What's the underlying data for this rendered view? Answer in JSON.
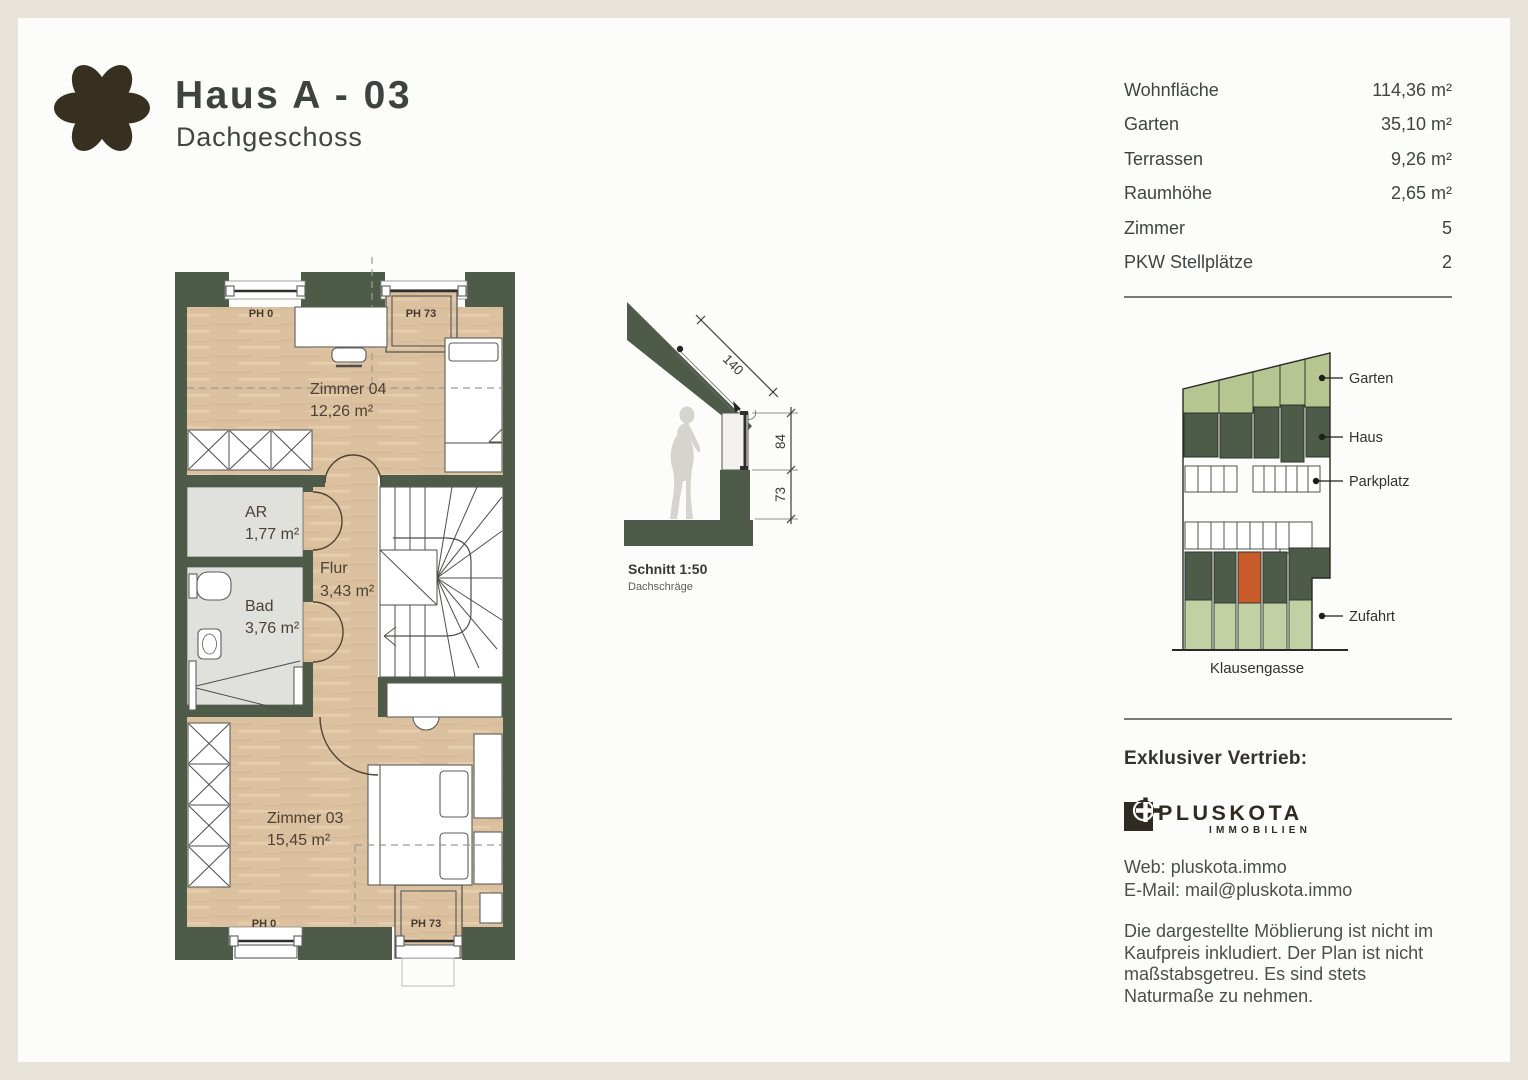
{
  "header": {
    "title": "Haus A - 03",
    "subtitle": "Dachgeschoss"
  },
  "stats": {
    "rows": [
      {
        "label": "Wohnfläche",
        "value": "114,36 m²"
      },
      {
        "label": "Garten",
        "value": "35,10 m²"
      },
      {
        "label": "Terrassen",
        "value": "9,26 m²"
      },
      {
        "label": "Raumhöhe",
        "value": "2,65 m²"
      },
      {
        "label": "Zimmer",
        "value": "5"
      },
      {
        "label": "PKW Stellplätze",
        "value": "2"
      }
    ]
  },
  "floorplan": {
    "rooms": {
      "zimmer04": {
        "name": "Zimmer 04",
        "area": "12,26 m²"
      },
      "ar": {
        "name": "AR",
        "area": "1,77 m²"
      },
      "flur": {
        "name": "Flur",
        "area": "3,43 m²"
      },
      "bad": {
        "name": "Bad",
        "area": "3,76 m²"
      },
      "zimmer03": {
        "name": "Zimmer 03",
        "area": "15,45 m²"
      }
    },
    "ph": {
      "top_left": "PH 0",
      "top_right": "PH 73",
      "bottom_left": "PH 0",
      "bottom_right": "PH 73"
    }
  },
  "schnitt": {
    "title": "Schnitt 1:50",
    "subtitle": "Dachschräge",
    "dim_slope": "140",
    "dim_upper": "84",
    "dim_lower": "73"
  },
  "siteplan": {
    "labels": {
      "garten": "Garten",
      "haus": "Haus",
      "parkplatz": "Parkplatz",
      "zufahrt": "Zufahrt"
    },
    "street": "Klausengasse"
  },
  "vendor": {
    "heading": "Exklusiver Vertrieb:",
    "brand": "PLUSKOTA",
    "brand_sub": "IMMOBILIEN",
    "web": "Web: pluskota.immo",
    "email": "E-Mail: mail@pluskota.immo"
  },
  "disclaimer": "Die dargestellte Möblierung ist nicht im Kaufpreis inkludiert. Der Plan ist nicht maßstabsgetreu. Es sind stets Naturmaße zu nehmen.",
  "colors": {
    "background": "#e7e3da",
    "card": "#fcfcfb",
    "wall-green": "#4d5b48",
    "floor-wood": "#dcc1a0",
    "floor-gray": "#e0e0dd",
    "site-light-green": "#b7c591",
    "site-access-green": "#c2d1a3",
    "highlight-orange": "#c95b2b",
    "brand-dark": "#2f2a22",
    "ink": "#3d4341",
    "text": "#4a4f4d"
  }
}
